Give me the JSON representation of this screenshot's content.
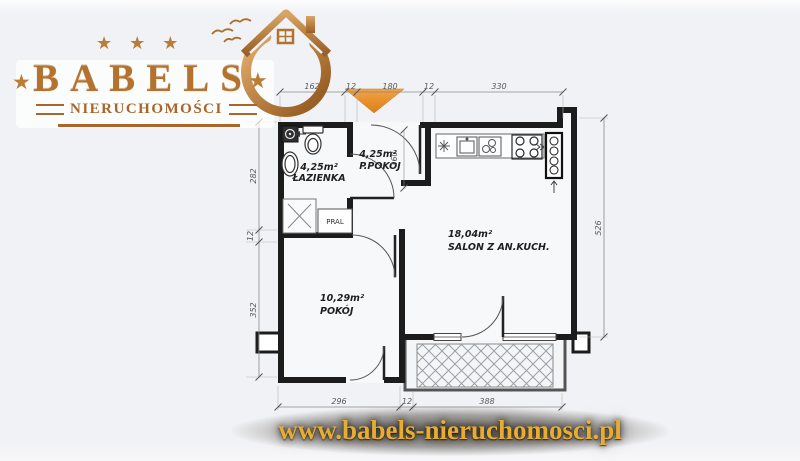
{
  "logo": {
    "brand": "BABELS",
    "subtitle": "NIERUCHOMOŚCI",
    "stars_top": [
      "★",
      "★",
      "★"
    ],
    "star_left": "★",
    "star_right": "★"
  },
  "footer": {
    "url": "www.babels-nieruchomosci.pl"
  },
  "floorplan": {
    "rooms": {
      "bathroom": {
        "area": "4,25m²",
        "name": "ŁAZIENKA"
      },
      "hall": {
        "area": "4,25m²",
        "name": "P.POKÓJ"
      },
      "salon": {
        "area": "18,04m²",
        "name": "SALON Z AN.KUCH."
      },
      "room": {
        "area": "10,29m²",
        "name": "POKÓJ"
      }
    },
    "washer_label": "PRAL",
    "dims": {
      "top": [
        "162",
        "12",
        "180",
        "12",
        "330"
      ],
      "left": [
        "282",
        "12",
        "352"
      ],
      "right": "526",
      "bottom": [
        "296",
        "12",
        "388"
      ],
      "hall_width": "160"
    }
  },
  "colors": {
    "entrance_arrow": "#e8913a",
    "wall": "#1c1c1c",
    "logo_copper": "#b4722f",
    "url_gold": "#e7ad33"
  }
}
